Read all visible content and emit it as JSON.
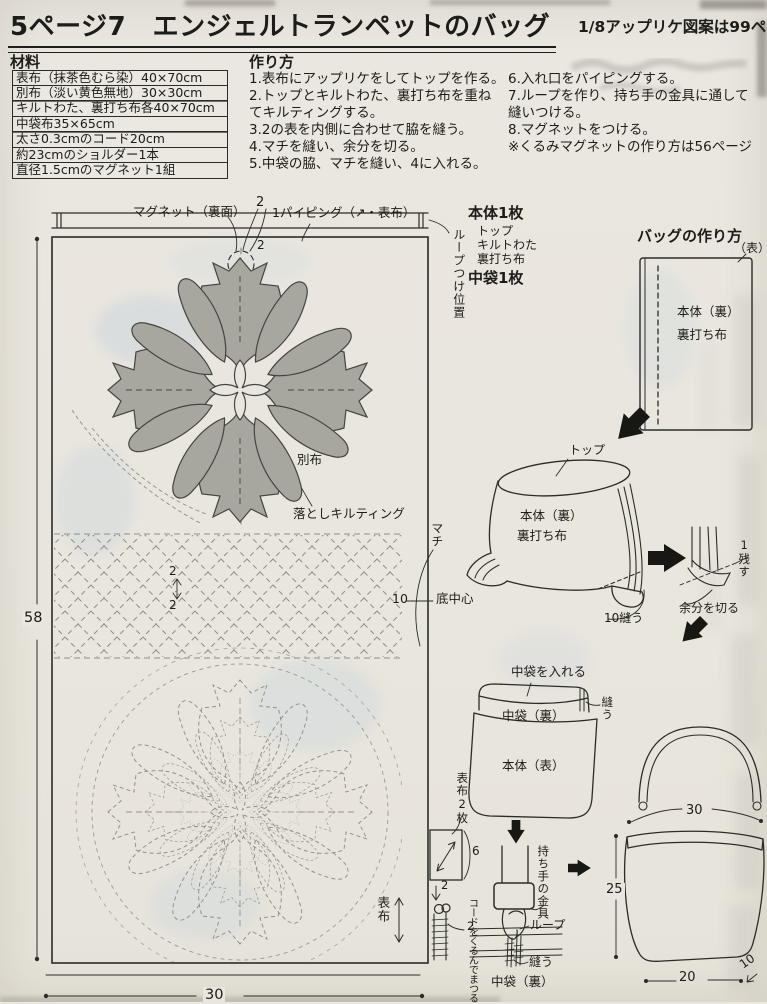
{
  "header": {
    "title": "5ページ7　エンジェルトランペットのバッグ",
    "corner_note": "1/8アップリケ図案は99ペ"
  },
  "materials": {
    "heading": "材料",
    "items": [
      "表布（抹茶色むら染）40×70cm",
      "別布（淡い黄色無地）30×30cm",
      "キルトわた、裏打ち布各40×70cm",
      "中袋布35×65cm",
      "太さ0.3cmのコード20cm",
      "約23cmのショルダー1本",
      "直径1.5cmのマグネット1組"
    ]
  },
  "howto": {
    "heading": "作り方",
    "left_lines": [
      "1.表布にアップリケをしてトップを作る。",
      "2.トップとキルトわた、裏打ち布を重ね",
      "てキルティングする。",
      "3.2の表を内側に合わせて脇を縫う。",
      "4.マチを縫い、余分を切る。",
      "5.中袋の脇、マチを縫い、4に入れる。"
    ],
    "right_lines": [
      "6.入れ口をパイピングする。",
      "7.ループを作り、持ち手の金具に通して",
      "縫いつける。",
      "8.マグネットをつける。",
      "※くるみマグネットの作り方は56ページ"
    ]
  },
  "cutting": {
    "body": "本体1枚",
    "layers": [
      "トップ",
      "キルトわた",
      "裏打ち布"
    ],
    "lining": "中袋1枚"
  },
  "pattern": {
    "magnet": "マグネット（裏面）",
    "magnet_dim": "2",
    "magnet_gap": "2",
    "piping": "1パイピング（↗・表布）",
    "loop_pos": "ループつけ位置",
    "applique": "別布",
    "ditch_quilt": "落としキルティング",
    "gusset": "マチ",
    "gusset_dim": "10",
    "bottom_center": "底中心",
    "grid_a": "2",
    "grid_b": "2",
    "height": "58",
    "width": "30",
    "grain": "表布"
  },
  "diagrams": {
    "heading": "バッグの作り方",
    "front_mark": "（表）",
    "body_back": "本体（裏）",
    "backing": "裏打ち布",
    "top_label": "トップ",
    "body_back2": "本体（裏）",
    "backing2": "裏打ち布",
    "sew10": "10縫う",
    "leave1": "1残す",
    "cut_excess": "余分を切る",
    "insert_lining": "中袋を入れる",
    "lining_back": "中袋（裏）",
    "sew_a": "縫う",
    "body_front": "本体（表）",
    "fabric2": "表布2枚",
    "dim6": "6",
    "dim2a": "2",
    "cord_note": "コードをくるんでまつる",
    "fitting": "持ち手の金具",
    "loop_dim": "2",
    "loop": "ループ",
    "sew_b": "縫う",
    "lining_back2": "中袋（裏）",
    "bag_w_top": "30",
    "bag_h": "25",
    "bag_w_bottom": "20",
    "bag_d": "10"
  }
}
